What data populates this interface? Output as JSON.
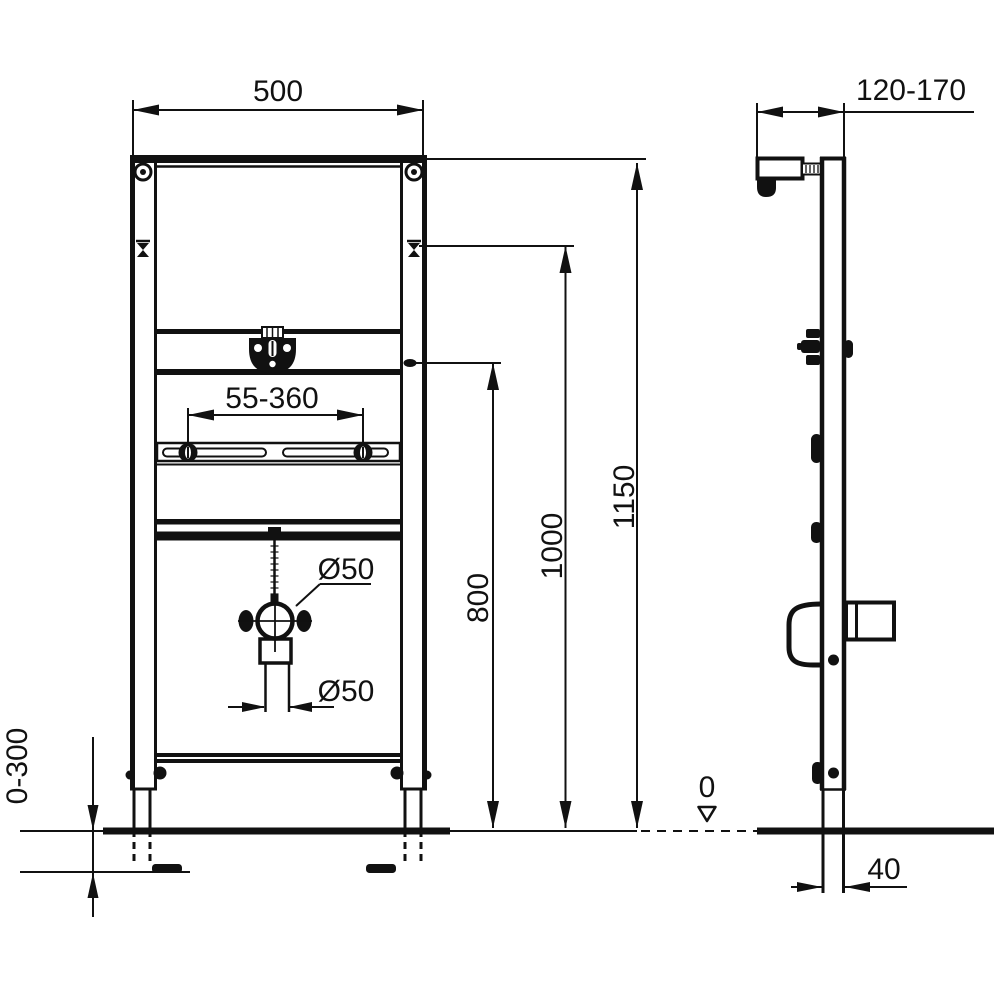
{
  "drawing": {
    "front": {
      "width": "500",
      "rail_range": "55-360",
      "clamp_diameter": "Ø50",
      "pipe_diameter": "Ø50",
      "height_total": "1150",
      "height_inlet": "1000",
      "height_tap": "800",
      "foot_adjustment": "0-300"
    },
    "side": {
      "depth_range": "120-170",
      "floor_level": "0",
      "foot_offset": "40"
    }
  }
}
